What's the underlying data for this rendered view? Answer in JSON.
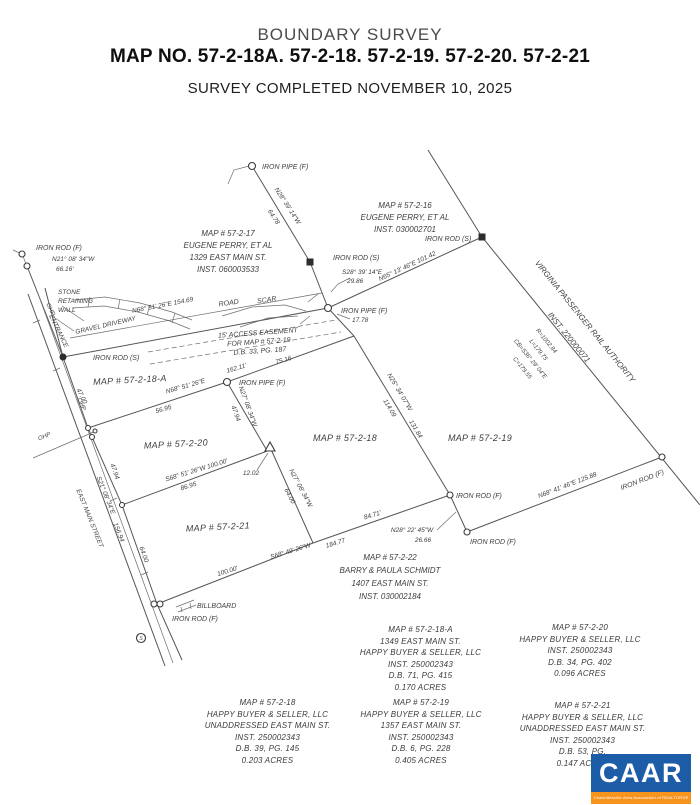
{
  "header": {
    "title": "BOUNDARY SURVEY",
    "map_no": "MAP NO. 57-2-18A. 57-2-18. 57-2-19. 57-2-20. 57-2-21",
    "completed": "SURVEY COMPLETED NOVEMBER 10, 2025"
  },
  "drawing": {
    "markers": {
      "iron_rod_f": "IRON ROD (F)",
      "iron_rod_s": "IRON ROD (S)",
      "iron_pipe_f": "IRON PIPE (F)"
    },
    "features": {
      "stone_1": "STONE",
      "stone_2": "RETAINING",
      "stone_3": "WALL",
      "gravel_driveway": "GRAVEL DRIVEWAY",
      "entrance": "ENTRANCE",
      "east_main_street": "EAST MAIN STREET",
      "ohp": "OHP",
      "road": "ROAD",
      "scar": "SCAR",
      "billboard": "BILLBOARD",
      "sign_s": "S",
      "easement_1": "15' ACCESS EASEMENT",
      "easement_2": "FOR MAP # 57-2-19",
      "easement_3": "D.B. 33, PG. 187",
      "vpra_1": "VIRGINIA PASSENGER RAIL AUTHORITY",
      "vpra_2": "INST. 220000071"
    },
    "bearings": {
      "n21_bearing": "N21° 08' 34\"W",
      "n21_dist": "66.16'",
      "n28_bearing": "N28° 39' 14\"W",
      "n28_dist": "64.78",
      "s28_bearing": "S28° 39' 14\"E",
      "s28_dist": "29.86",
      "n65": "N65° 13' 46\"E  101.42",
      "n68_154": "N68° 51' 26\"E  154.69",
      "n68_162_bearing": "N68° 51' 26\"E",
      "n68_162_dist": "162.11'",
      "d75": "75.16",
      "d17": "17.78",
      "d56": "56.95",
      "d47": "47.00",
      "n27a_bearing": "N27° 08' 34\"W",
      "n27a_dist": "47.94",
      "n25_bearing": "N25° 34' 07\"W",
      "n25_d1": "114.09",
      "n25_d2": "131.84",
      "s68_100": "S68° 51' 26\"W  100.00'",
      "d86": "86.95",
      "d12": "12.02",
      "n27b_bearing": "N27° 08' 34\"W",
      "n27b_dist": "64.00",
      "road_bearing": "S21° 08' 34\"E",
      "road_dist": "156.94",
      "road_d64": "64.00",
      "road_d47": "47.94",
      "d100": "100.00'",
      "s68_184_bearing": "S68° 49' 26\"W",
      "s68_184_dist": "184.77",
      "d84": "84.71'",
      "n28b_bearing": "N28° 22' 45\"W",
      "n28b_dist": "26.66",
      "n68_125": "N68° 41' 46\"E  125.88",
      "curve_r": "R=1002.84",
      "curve_l": "L=179.75",
      "curve_cb": "CB=S36° 29' 04\"E",
      "curve_c": "C=179.55"
    },
    "parcels": {
      "p16_1": "MAP # 57-2-16",
      "p16_2": "EUGENE PERRY, ET AL",
      "p16_3": "INST. 030002701",
      "p17_1": "MAP # 57-2-17",
      "p17_2": "EUGENE PERRY, ET AL",
      "p17_3": "1329 EAST MAIN ST.",
      "p17_4": "INST. 060003533",
      "p18a": "MAP # 57-2-18-A",
      "p18": "MAP # 57-2-18",
      "p19": "MAP # 57-2-19",
      "p20": "MAP # 57-2-20",
      "p21": "MAP # 57-2-21",
      "p22_1": "MAP # 57-2-22",
      "p22_2": "BARRY & PAULA SCHMIDT",
      "p22_3": "1407 EAST MAIN ST.",
      "p22_4": "INST. 030002184"
    }
  },
  "footer": {
    "b1": [
      "MAP # 57-2-18-A",
      "1349 EAST MAIN ST.",
      "HAPPY BUYER & SELLER, LLC",
      "INST. 250002343",
      "D.B. 71, PG. 415",
      "0.170 ACRES"
    ],
    "b2": [
      "MAP # 57-2-20",
      "HAPPY BUYER & SELLER, LLC",
      "INST. 250002343",
      "D.B. 34, PG. 402",
      "0.096 ACRES"
    ],
    "b3": [
      "MAP # 57-2-18",
      "HAPPY BUYER & SELLER, LLC",
      "UNADDRESSED EAST MAIN ST.",
      "INST. 250002343",
      "D.B. 39, PG. 145",
      "0.203 ACRES"
    ],
    "b4": [
      "MAP # 57-2-19",
      "HAPPY BUYER & SELLER, LLC",
      "1357 EAST MAIN ST.",
      "INST. 250002343",
      "D.B. 6, PG. 228",
      "0.405 ACRES"
    ],
    "b5": [
      "MAP # 57-2-21",
      "HAPPY BUYER & SELLER, LLC",
      "UNADDRESSED EAST MAIN ST.",
      "INST. 250002343",
      "D.B. 53, PG.",
      "0.147 ACRES"
    ]
  },
  "logo": {
    "text": "CAAR",
    "tagline": "Charlottesville Area Association of REALTORS®",
    "blue": "#1d5ca6",
    "orange": "#f7941d"
  },
  "colors": {
    "ink": "#3e3e3e",
    "paper": "#ffffff"
  }
}
